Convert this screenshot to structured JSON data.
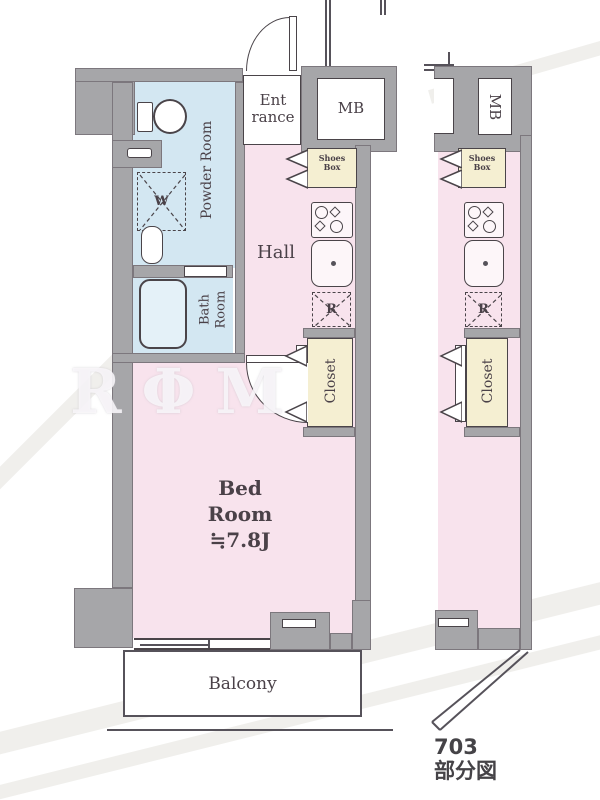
{
  "title": "apartment floor plan",
  "rooms": {
    "entrance": {
      "line1": "Ent",
      "line2": "rance"
    },
    "mb": "MB",
    "shoes_box": {
      "line1": "Shoes",
      "line2": "Box"
    },
    "hall": "Hall",
    "powder_room": "Powder Room",
    "bath_room": {
      "line1": "Bath",
      "line2": "Room"
    },
    "closet": "Closet",
    "bed_room": {
      "line1": "Bed",
      "line2": "Room",
      "line3": "≒7.8J"
    },
    "balcony": "Balcony",
    "washer_space": "W",
    "refrigerator_space": "R"
  },
  "partial_view": {
    "caption_line1": "703",
    "caption_line2": "部分図"
  },
  "watermark": "RΦM",
  "colors": {
    "wall": "#a6a6a9",
    "wet_area": "#d3e7f2",
    "living_area": "#f8e3ed",
    "storage": "#f5efd2",
    "outline": "#4a4449",
    "text": "#4a4148"
  }
}
